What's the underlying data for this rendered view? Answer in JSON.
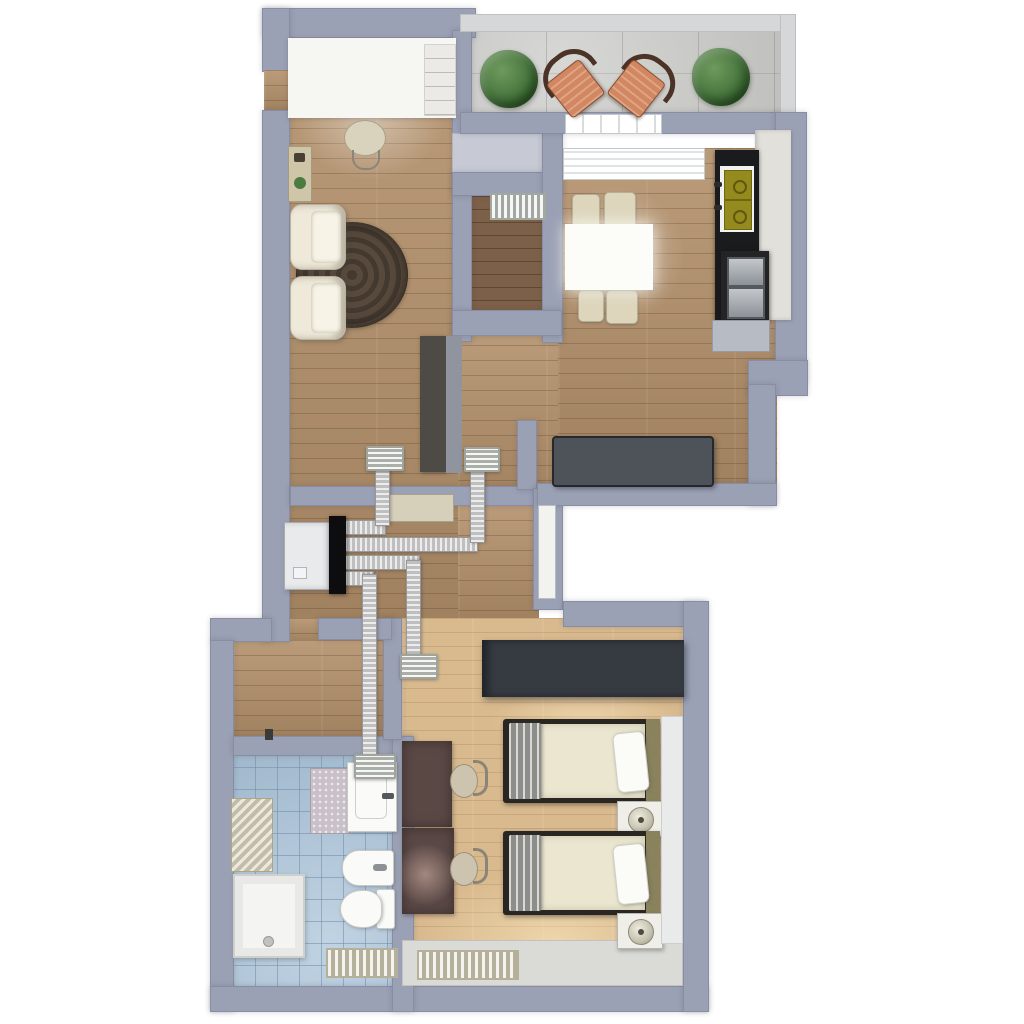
{
  "meta": {
    "type": "3d-floor-plan-render",
    "view": "top-down",
    "description": "Apartment floor plan with mechanical ventilation heat-recovery unit and flexible ducting"
  },
  "colors": {
    "page_bg": "#ffffff",
    "wall": "#9ba1b5",
    "wall_light": "#c7cad4",
    "balcony_wall": "#d6d7d9",
    "floor_wood": "#b3906a",
    "floor_wood_dark": "#7d6048",
    "floor_wood_bedroom": "#d9ba8e",
    "floor_tile": "#abc4d9",
    "floor_balcony": "#cacac7",
    "furniture_white": "#f6f6f3",
    "cream": "#ddd6bd",
    "counter_dark": "#1a1b1d",
    "bench": "#4d5358",
    "wardrobe": "#363b42",
    "desk_brown": "#5a4845",
    "sink_olive": "#948a1e",
    "chair_salmon": "#d28760",
    "chair_frame": "#4b3427",
    "duct_light": "#ececec",
    "duct_dark": "#bfbfbf",
    "vent_face": "#d3d8d0",
    "unit_white": "#e9eaec",
    "unit_black": "#0d0d0f",
    "blanket_gray": "#a8a8a4",
    "duvet": "#ebe6d0",
    "headboard_olive": "#8a825c",
    "bed_frame": "#2a2622",
    "mat_lilac": "#c9c0ca",
    "radiator_beige": "#dcd8c5",
    "glow_warm": "rgba(255,235,195,0.55)"
  },
  "rooms": [
    {
      "id": "living-room-office",
      "floor": "oak-wood",
      "furniture": [
        "desk-workstation",
        "shelf-column",
        "office-chair",
        "sideboard",
        "round-rug",
        "armchair",
        "armchair"
      ]
    },
    {
      "id": "hallway",
      "floor": "oak-wood",
      "furniture": [
        "tall-cabinet",
        "open-door-panel"
      ]
    },
    {
      "id": "storage-closet",
      "floor": "dark-wood",
      "furniture": [
        "door-transom-grille"
      ]
    },
    {
      "id": "kitchen-dining",
      "floor": "oak-wood",
      "furniture": [
        "dining-table",
        "dining-chair",
        "dining-chair",
        "dining-chair",
        "dining-chair",
        "kitchen-counter",
        "double-sink",
        "wall-oven",
        "tall-cabinet",
        "lower-counter",
        "bench"
      ]
    },
    {
      "id": "balcony",
      "floor": "concrete-tile",
      "furniture": [
        "potted-plant",
        "bistro-chair",
        "bistro-chair",
        "potted-plant"
      ]
    },
    {
      "id": "entry-hall",
      "floor": "oak-wood",
      "furniture": []
    },
    {
      "id": "bathroom",
      "floor": "blue-tile",
      "furniture": [
        "storage-cabinet",
        "shower-tray",
        "bath-mat",
        "washbasin",
        "bidet",
        "toilet",
        "floor-radiator"
      ]
    },
    {
      "id": "bedroom",
      "floor": "light-oak-wood",
      "furniture": [
        "wardrobe",
        "desk",
        "desk",
        "desk-chair",
        "desk-chair",
        "single-bed",
        "single-bed",
        "nightstand-with-lamp",
        "nightstand-with-lamp",
        "floor-radiator",
        "window-sill"
      ]
    }
  ],
  "ventilation": {
    "unit": "heat-recovery-ventilation-unit",
    "duct_type": "flexible-silver-duct",
    "duct_runs": [
      "unit-to-living-room-vent",
      "unit-to-hall-kitchen-vent",
      "unit-to-bedroom-vent",
      "unit-to-bathroom-vent"
    ],
    "ceiling_vents": 4,
    "transom_grilles": 1
  }
}
